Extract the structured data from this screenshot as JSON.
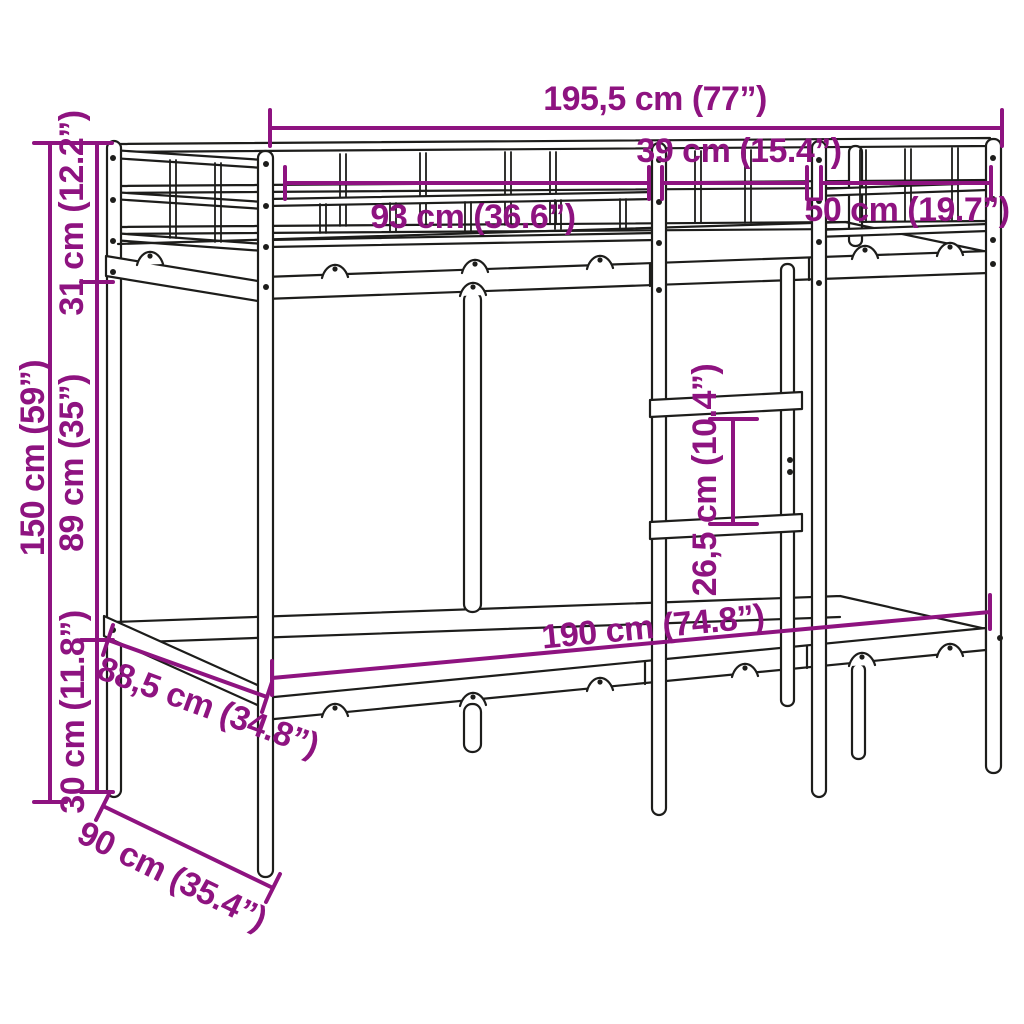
{
  "colors": {
    "background": "#ffffff",
    "line_art": "#1d1d1b",
    "dimension": "#8E1380"
  },
  "dimensions": {
    "total_length": {
      "label": "195,5 cm (77”)"
    },
    "left_guardrail": {
      "label": "93 cm (36.6”)"
    },
    "ladder_opening": {
      "label": "39 cm (15.4”)"
    },
    "right_guardrail": {
      "label": "50 cm (19.7”)"
    },
    "total_height": {
      "label": "150 cm (59”)"
    },
    "guardrail_height": {
      "label": "31 cm (12.2”)"
    },
    "clearance_height": {
      "label": "89 cm (35”)"
    },
    "base_height": {
      "label": "30 cm (11.8”)"
    },
    "rung_spacing": {
      "label": "26,5 cm (10.4”)"
    },
    "bed_length": {
      "label": "190 cm (74.8”)"
    },
    "frame_width": {
      "label": "88,5 cm (34.8”)"
    },
    "bed_width": {
      "label": "90 cm (35.4”)"
    }
  }
}
